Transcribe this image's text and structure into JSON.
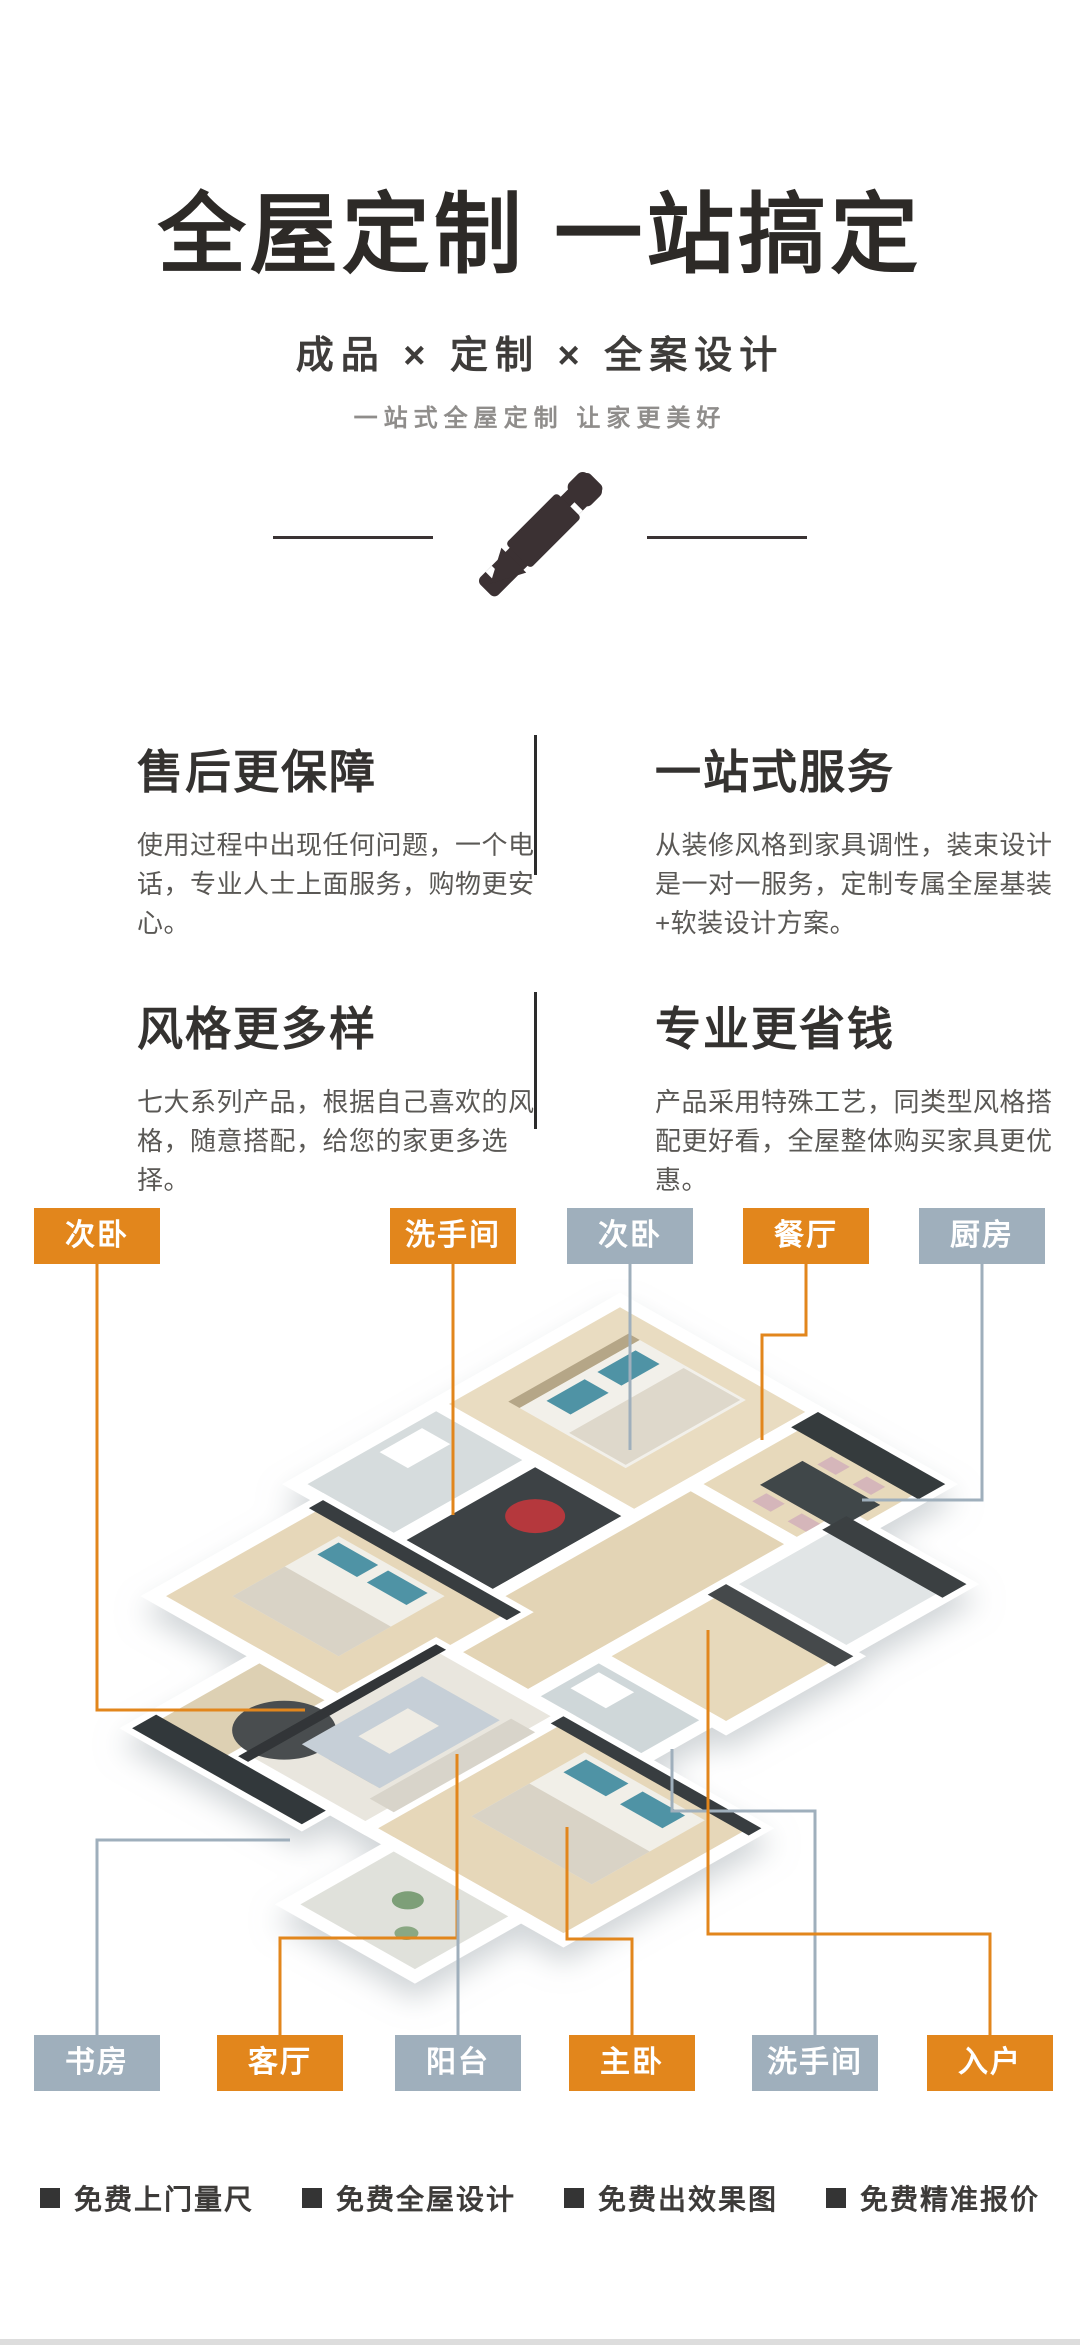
{
  "header": {
    "title": "全屋定制 一站搞定",
    "subtitle": "成品 × 定制 × 全案设计",
    "tagline": "一站式全屋定制 让家更美好",
    "icon": "pencil-ruler"
  },
  "features": [
    {
      "title": "售后更保障",
      "desc": "使用过程中出现任何问题，一个电话，专业人士上面服务，购物更安心。"
    },
    {
      "title": "一站式服务",
      "desc": "从装修风格到家具调性，装束设计是一对一服务，定制专属全屋基装+软装设计方案。"
    },
    {
      "title": "风格更多样",
      "desc": "七大系列产品，根据自己喜欢的风格，随意搭配，给您的家更多选择。"
    },
    {
      "title": "专业更省钱",
      "desc": "产品采用特殊工艺，同类型风格搭配更好看，全屋整体购买家具更优惠。"
    }
  ],
  "floorplan": {
    "top_labels": [
      {
        "label": "次卧",
        "variant": "orange"
      },
      {
        "label": "洗手间",
        "variant": "orange"
      },
      {
        "label": "次卧",
        "variant": "gray"
      },
      {
        "label": "餐厅",
        "variant": "orange"
      },
      {
        "label": "厨房",
        "variant": "gray"
      }
    ],
    "bottom_labels": [
      {
        "label": "书房",
        "variant": "gray"
      },
      {
        "label": "客厅",
        "variant": "orange"
      },
      {
        "label": "阳台",
        "variant": "gray"
      },
      {
        "label": "主卧",
        "variant": "orange"
      },
      {
        "label": "洗手间",
        "variant": "gray"
      },
      {
        "label": "入户",
        "variant": "orange"
      }
    ]
  },
  "colors": {
    "accent_orange": "#e2861c",
    "label_gray": "#9fafbc"
  },
  "footer": {
    "items": [
      "免费上门量尺",
      "免费全屋设计",
      "免费出效果图",
      "免费精准报价"
    ]
  }
}
